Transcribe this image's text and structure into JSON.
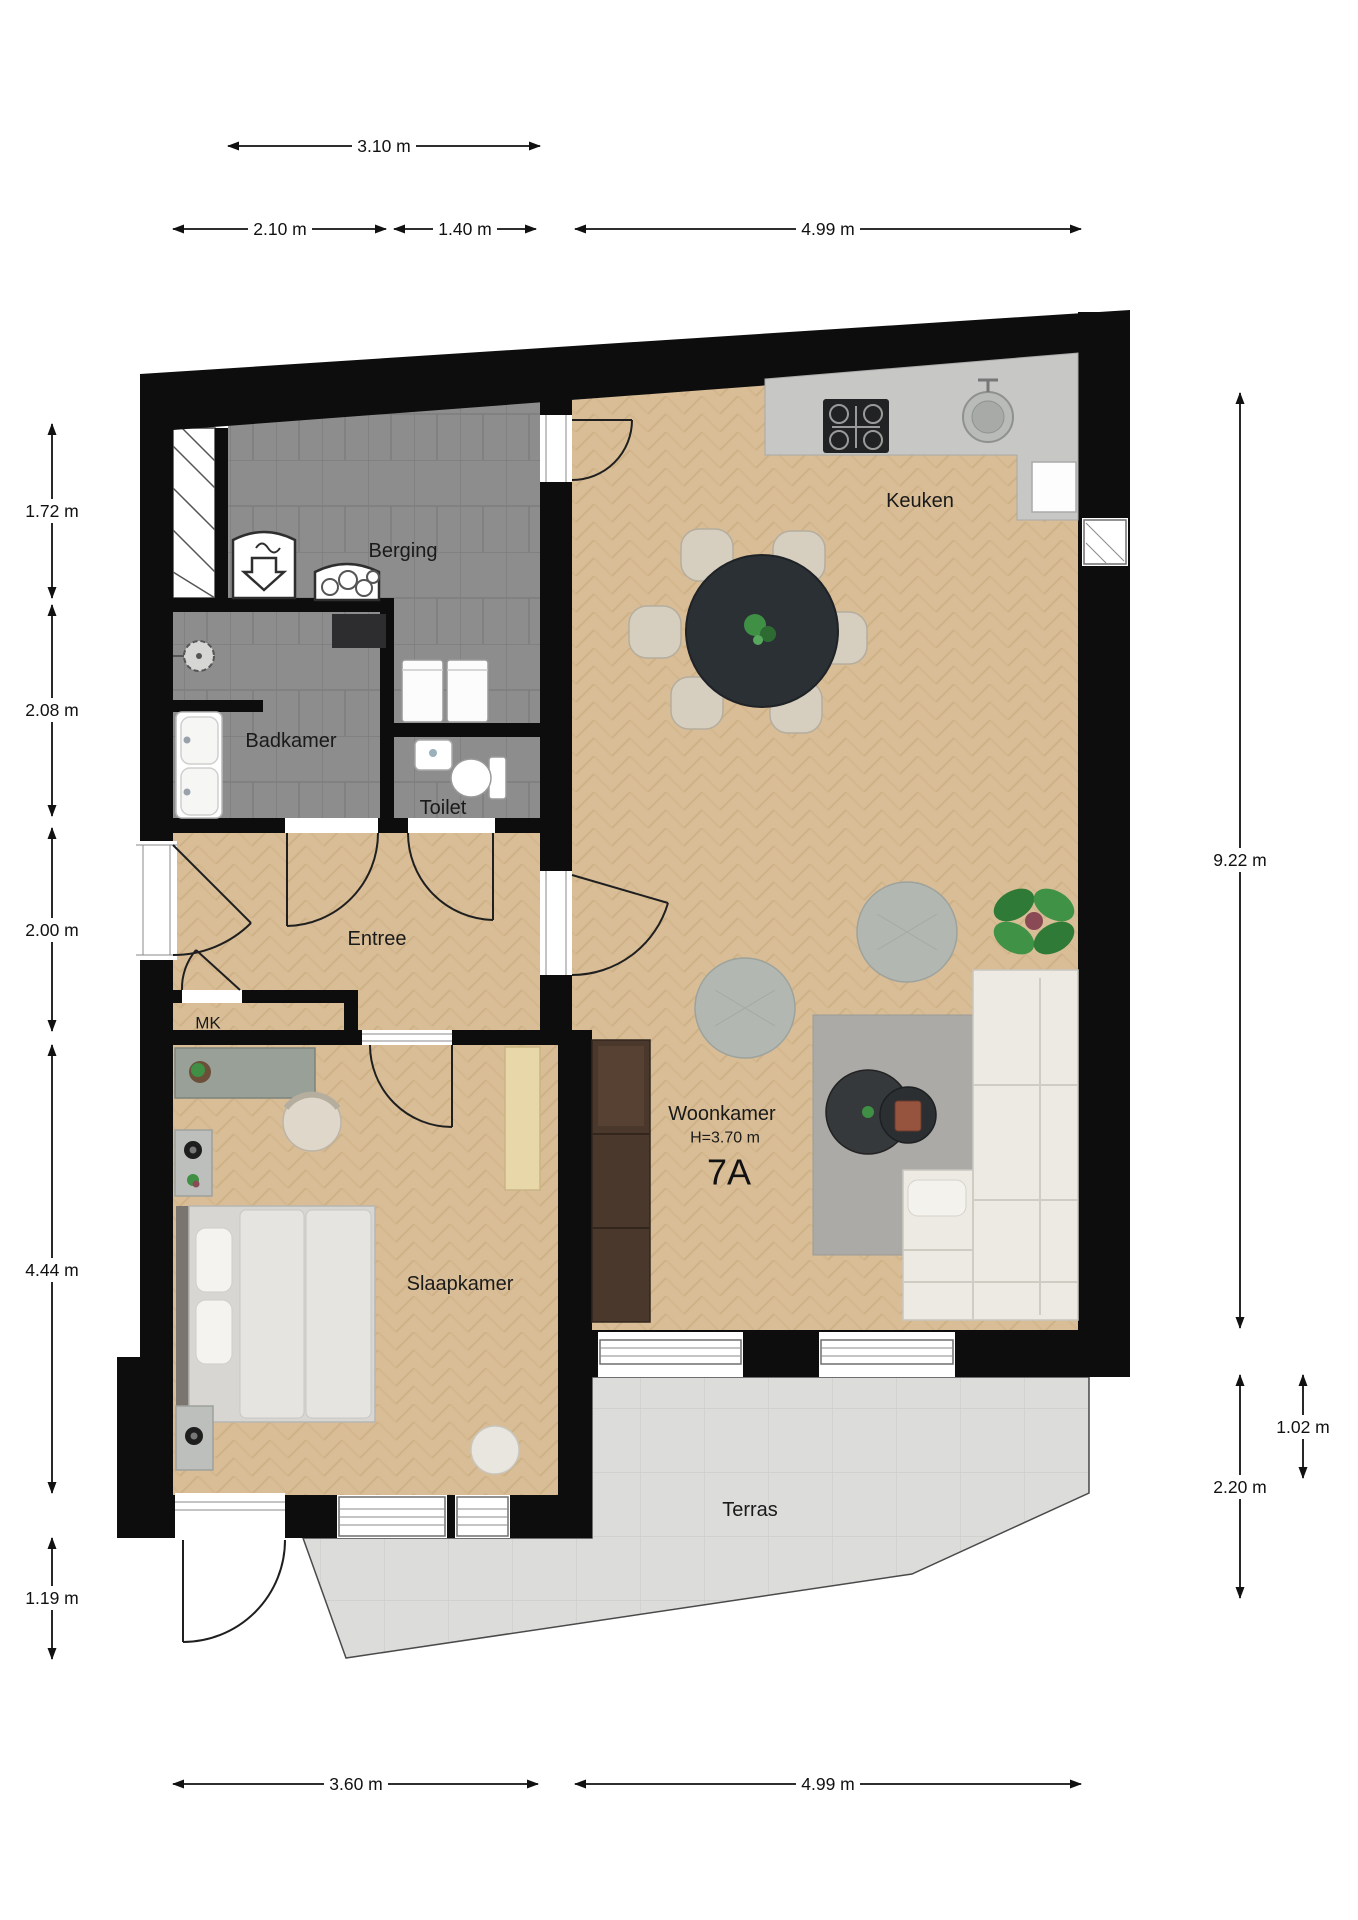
{
  "plan": {
    "unit": "7A",
    "height_note": "H=3.70 m",
    "rooms": {
      "berging": "Berging",
      "badkamer": "Badkamer",
      "toilet": "Toilet",
      "entree": "Entree",
      "mk": "MK",
      "slaapkamer": "Slaapkamer",
      "woonkamer": "Woonkamer",
      "keuken": "Keuken",
      "terras": "Terras"
    }
  },
  "dimensions": {
    "top_upper": [
      {
        "id": "berging-width",
        "label": "3.10 m"
      }
    ],
    "top_lower": [
      {
        "id": "badkamer-width",
        "label": "2.10 m"
      },
      {
        "id": "toilet-zone-width",
        "label": "1.40 m"
      },
      {
        "id": "woonkamer-width",
        "label": "4.99 m"
      }
    ],
    "left": [
      {
        "id": "berging-depth",
        "label": "1.72 m"
      },
      {
        "id": "badkamer-depth",
        "label": "2.08 m"
      },
      {
        "id": "entree-depth",
        "label": "2.00 m"
      },
      {
        "id": "slaapkamer-depth",
        "label": "4.44 m"
      },
      {
        "id": "terras-left-depth",
        "label": "1.19 m"
      }
    ],
    "right": [
      {
        "id": "living-total-depth",
        "label": "9.22 m"
      },
      {
        "id": "terras-step",
        "label": "1.02 m"
      },
      {
        "id": "terras-depth",
        "label": "2.20 m"
      }
    ],
    "bottom": [
      {
        "id": "slaapkamer-width",
        "label": "3.60 m"
      },
      {
        "id": "woonkamer-width-bottom",
        "label": "4.99 m"
      }
    ]
  },
  "colors": {
    "wall": "#0d0d0d",
    "wood": "#d8bd97",
    "wood_line": "#c8a878",
    "tile": "#8d8d8d",
    "tile_line": "#7d7d7d",
    "terras": "#dcdcda",
    "counter": "#c7c7c5",
    "sofa": "#eceae3",
    "table_dark": "#2b3034",
    "plant_green": "#3f8f45",
    "wardrobe_brown": "#4b382c"
  }
}
